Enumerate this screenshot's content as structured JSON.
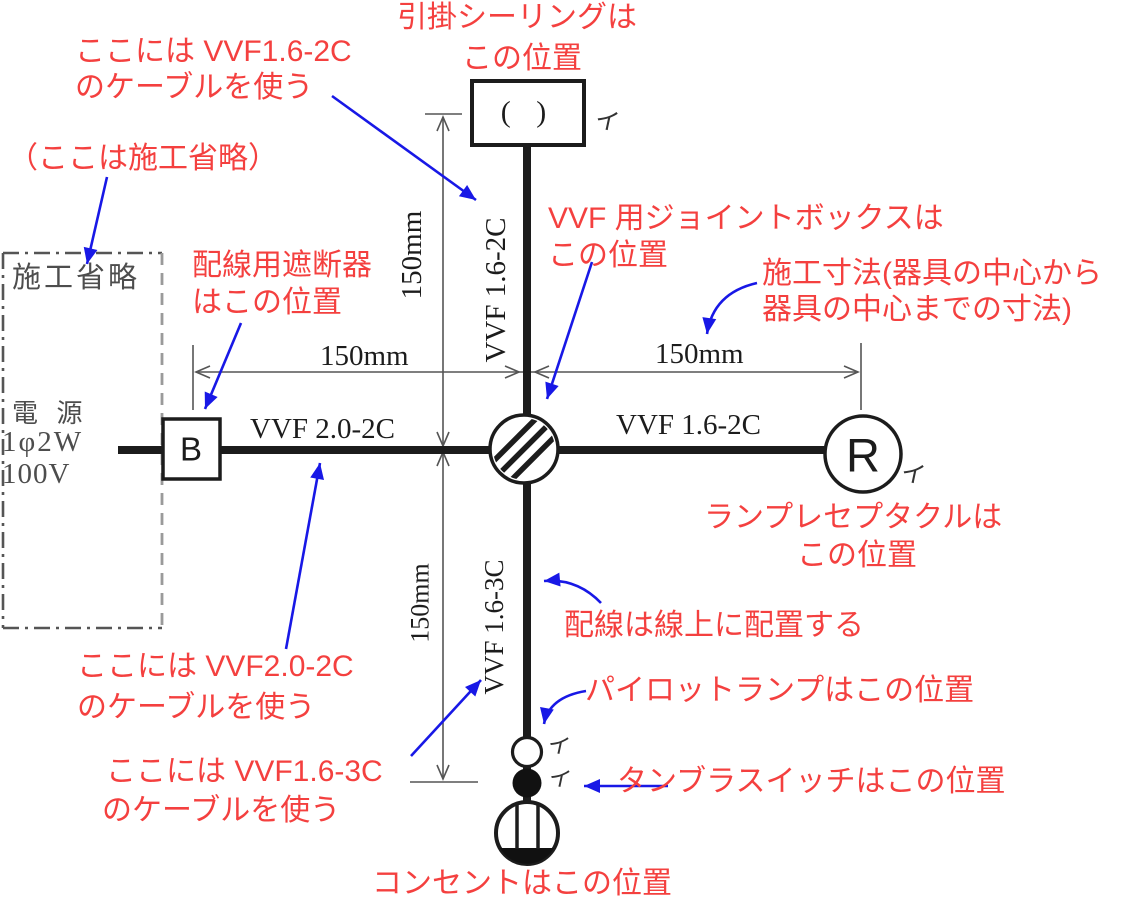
{
  "annotations": {
    "ceiling_l1": "引掛シーリングは",
    "ceiling_l2": "この位置",
    "cable_top_l1": "ここには VVF1.6-2C",
    "cable_top_l2": "のケーブルを使う",
    "omission_note": "（ここは施工省略）",
    "breaker_l1": "配線用遮断器",
    "breaker_l2": "はこの位置",
    "jointbox_l1": "VVF 用ジョイントボックスは",
    "jointbox_l2": "この位置",
    "dimension_l1": "施工寸法(器具の中心から",
    "dimension_l2": "器具の中心までの寸法)",
    "receptacle_l1": "ランプレセプタクルは",
    "receptacle_l2": "この位置",
    "wiring_on_line": "配線は線上に配置する",
    "pilot_lamp": "パイロットランプはこの位置",
    "tumbler_switch": "タンブラスイッチはこの位置",
    "outlet": "コンセントはこの位置",
    "cable_left_l1": "ここには VVF2.0-2C",
    "cable_left_l2": "のケーブルを使う",
    "cable_bottom_l1": "ここには VVF1.6-3C",
    "cable_bottom_l2": "のケーブルを使う"
  },
  "labels": {
    "omission_box": "施工省略",
    "power_l1": "電 源",
    "power_l2": "1φ2W",
    "power_l3": "100V",
    "cable_left": "VVF 2.0-2C",
    "cable_right": "VVF 1.6-2C",
    "cable_top_vertical": "VVF 1.6-2C",
    "cable_bottom_vertical": "VVF 1.6-3C",
    "dim_left": "150mm",
    "dim_right": "150mm",
    "dim_top_vertical": "150mm",
    "dim_bottom_vertical": "150mm",
    "breaker": "B",
    "receptacle": "R",
    "ceiling_symbol": "( )",
    "circuit_i_ceiling": "イ",
    "circuit_i_receptacle": "イ",
    "circuit_i_pilot": "イ",
    "circuit_i_switch": "イ"
  },
  "colors": {
    "annotation_red": "#f4403f",
    "arrow_blue": "#1818e6",
    "line_black": "#1c1c1c",
    "dimension_gray": "#555555"
  }
}
